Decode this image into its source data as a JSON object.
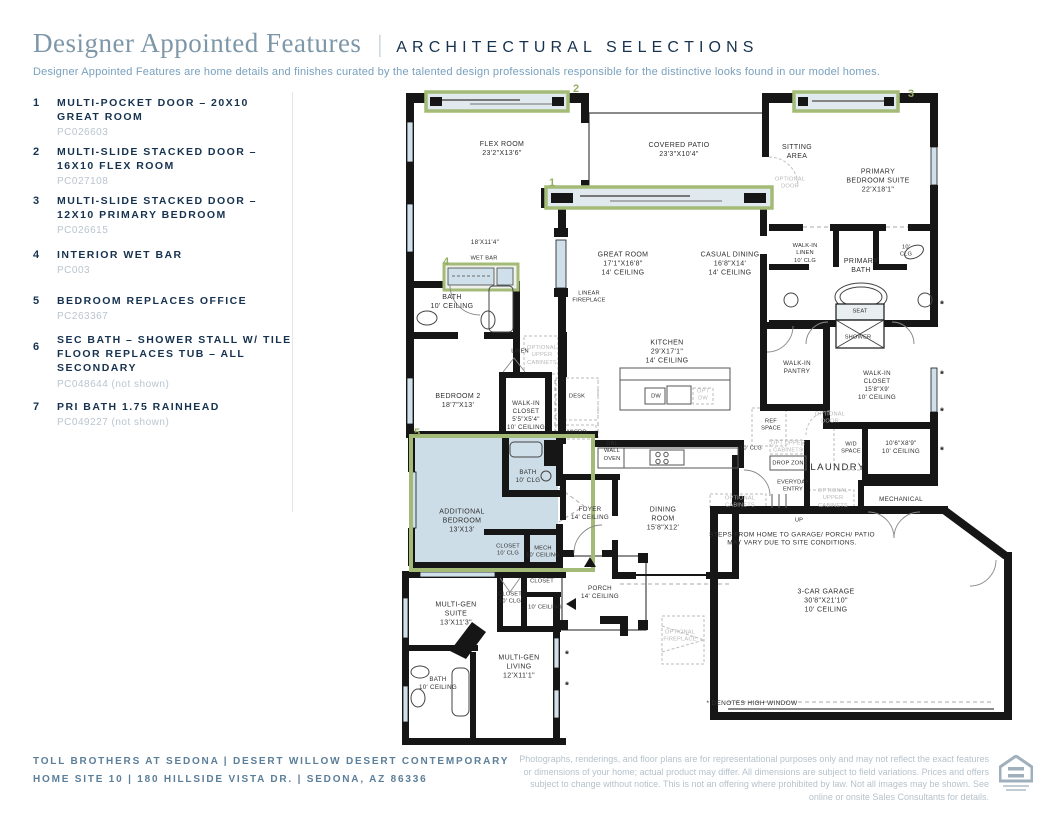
{
  "header": {
    "title": "Designer Appointed Features",
    "separator": "|",
    "section": "ARCHITECTURAL SELECTIONS",
    "description": "Designer Appointed Features are home details and finishes curated by the talented design professionals responsible for the distinctive looks found in our model homes."
  },
  "features": [
    {
      "num": "1",
      "title": "MULTI-POCKET DOOR – 20X10 GREAT ROOM",
      "code": "PC026603"
    },
    {
      "num": "2",
      "title": "MULTI-SLIDE STACKED DOOR – 16X10 FLEX ROOM",
      "code": "PC027108"
    },
    {
      "num": "3",
      "title": "MULTI-SLIDE STACKED DOOR – 12X10 PRIMARY BEDROOM",
      "code": "PC026615"
    },
    {
      "num": "4",
      "title": "INTERIOR WET BAR",
      "code": "PC003"
    },
    {
      "num": "5",
      "title": "BEDROOM REPLACES OFFICE",
      "code": "PC263367"
    },
    {
      "num": "6",
      "title": "SEC BATH – SHOWER STALL W/ TILE FLOOR REPLACES TUB – ALL SECONDARY",
      "code": "PC048644 (not shown)"
    },
    {
      "num": "7",
      "title": "PRI BATH 1.75 RAINHEAD",
      "code": "PC049227 (not shown)"
    }
  ],
  "plan": {
    "asterisk": "*",
    "markers": [
      {
        "n": "1"
      },
      {
        "n": "2"
      },
      {
        "n": "3"
      },
      {
        "n": "4"
      },
      {
        "n": "5"
      }
    ],
    "labels": [
      {
        "t": "FLEX ROOM\n23'2\"X13'6\""
      },
      {
        "t": "COVERED PATIO\n23'3\"X10'4\""
      },
      {
        "t": "SITTING\nAREA"
      },
      {
        "t": "PRIMARY\nBEDROOM SUITE\n22'X18'1\""
      },
      {
        "t": "OPTIONAL\nDOOR"
      },
      {
        "t": "GREAT ROOM\n17'1\"X16'8\"\n14' CEILING"
      },
      {
        "t": "CASUAL DINING\n16'8\"X14'\n14' CEILING"
      },
      {
        "t": "LINEAR\nFIREPLACE"
      },
      {
        "t": "18'X11'4\""
      },
      {
        "t": "WET BAR"
      },
      {
        "t": "BATH\n10' CEILING"
      },
      {
        "t": "LINEN"
      },
      {
        "t": "OPTIONAL\nUPPER\nCABINETS"
      },
      {
        "t": "WALK-IN\nLINEN\n10' CLG"
      },
      {
        "t": "PRIMARY\nBATH"
      },
      {
        "t": "10'\nCLG"
      },
      {
        "t": "SEAT"
      },
      {
        "t": "SHOWER"
      },
      {
        "t": "KITCHEN\n29'X17'1\"\n14' CEILING"
      },
      {
        "t": "DW"
      },
      {
        "t": "OPT\nDW"
      },
      {
        "t": "WALK-IN\nPANTRY"
      },
      {
        "t": "DESK"
      },
      {
        "t": "BEDROOM 2\n18'7\"X13'"
      },
      {
        "t": "WALK-IN\nCLOSET\n5'5\"X5'4\"\n10' CEILING"
      },
      {
        "t": "MICRO"
      },
      {
        "t": "DBL\nWALL\nOVEN"
      },
      {
        "t": "REF\nSPACE"
      },
      {
        "t": "WALK-IN\nCLOSET\n15'8\"X9'\n10' CEILING"
      },
      {
        "t": "OPTIONAL\nDOOR"
      },
      {
        "t": "W/D\nSPACE"
      },
      {
        "t": "10'6\"X8'9\"\n10' CEILING"
      },
      {
        "t": "OPT UPPER\nCABINETS"
      },
      {
        "t": "DROP ZONE"
      },
      {
        "t": "LAUNDRY"
      },
      {
        "t": "EVERYDAY\nENTRY"
      },
      {
        "t": "OPTIONAL\nUPPER\nCABINETS"
      },
      {
        "t": "MECHANICAL"
      },
      {
        "t": "OPTIONAL\nCABINETS"
      },
      {
        "t": "UP"
      },
      {
        "t": "STEPS FROM HOME TO GARAGE/ PORCH/ PATIO\nMAY VARY DUE TO SITE CONDITIONS."
      },
      {
        "t": "3-CAR GARAGE\n30'8\"X21'10\"\n10' CEILING"
      },
      {
        "t": "10' CLG"
      },
      {
        "t": "ADDITIONAL\nBEDROOM\n13'X13'"
      },
      {
        "t": "BATH\n10' CLG"
      },
      {
        "t": "CLOSET\n10' CLG"
      },
      {
        "t": "MECH\n10' CEILING"
      },
      {
        "t": "FOYER\n14' CEILING"
      },
      {
        "t": "DINING\nROOM\n15'8\"X12'"
      },
      {
        "t": "PORCH\n14' CEILING"
      },
      {
        "t": "MULTI-GEN\nSUITE\n13'X11'3\""
      },
      {
        "t": "CLOSET\n10' CLG"
      },
      {
        "t": "CLOSET"
      },
      {
        "t": "10' CEILING"
      },
      {
        "t": "MULTI-GEN\nLIVING\n12'X11'1\""
      },
      {
        "t": "BATH\n10' CEILING"
      },
      {
        "t": "OPTIONAL\nFIREPLACE"
      },
      {
        "t": "* DENOTES HIGH WINDOW"
      }
    ]
  },
  "footer": {
    "line1": "TOLL BROTHERS AT SEDONA   |   DESERT WILLOW DESERT CONTEMPORARY",
    "line2": "HOME SITE 10   |   180 HILLSIDE VISTA DR.   |   SEDONA, AZ 86336",
    "disclaimer": "Photographs, renderings, and floor plans are for representational purposes only and may not reflect the exact features or dimensions of your home; actual product may differ. All dimensions are subject to field variations. Prices and offers subject to change without notice. This is not an offering where prohibited by law. Not all images may be shown. See online or onsite Sales Consultants for details."
  }
}
